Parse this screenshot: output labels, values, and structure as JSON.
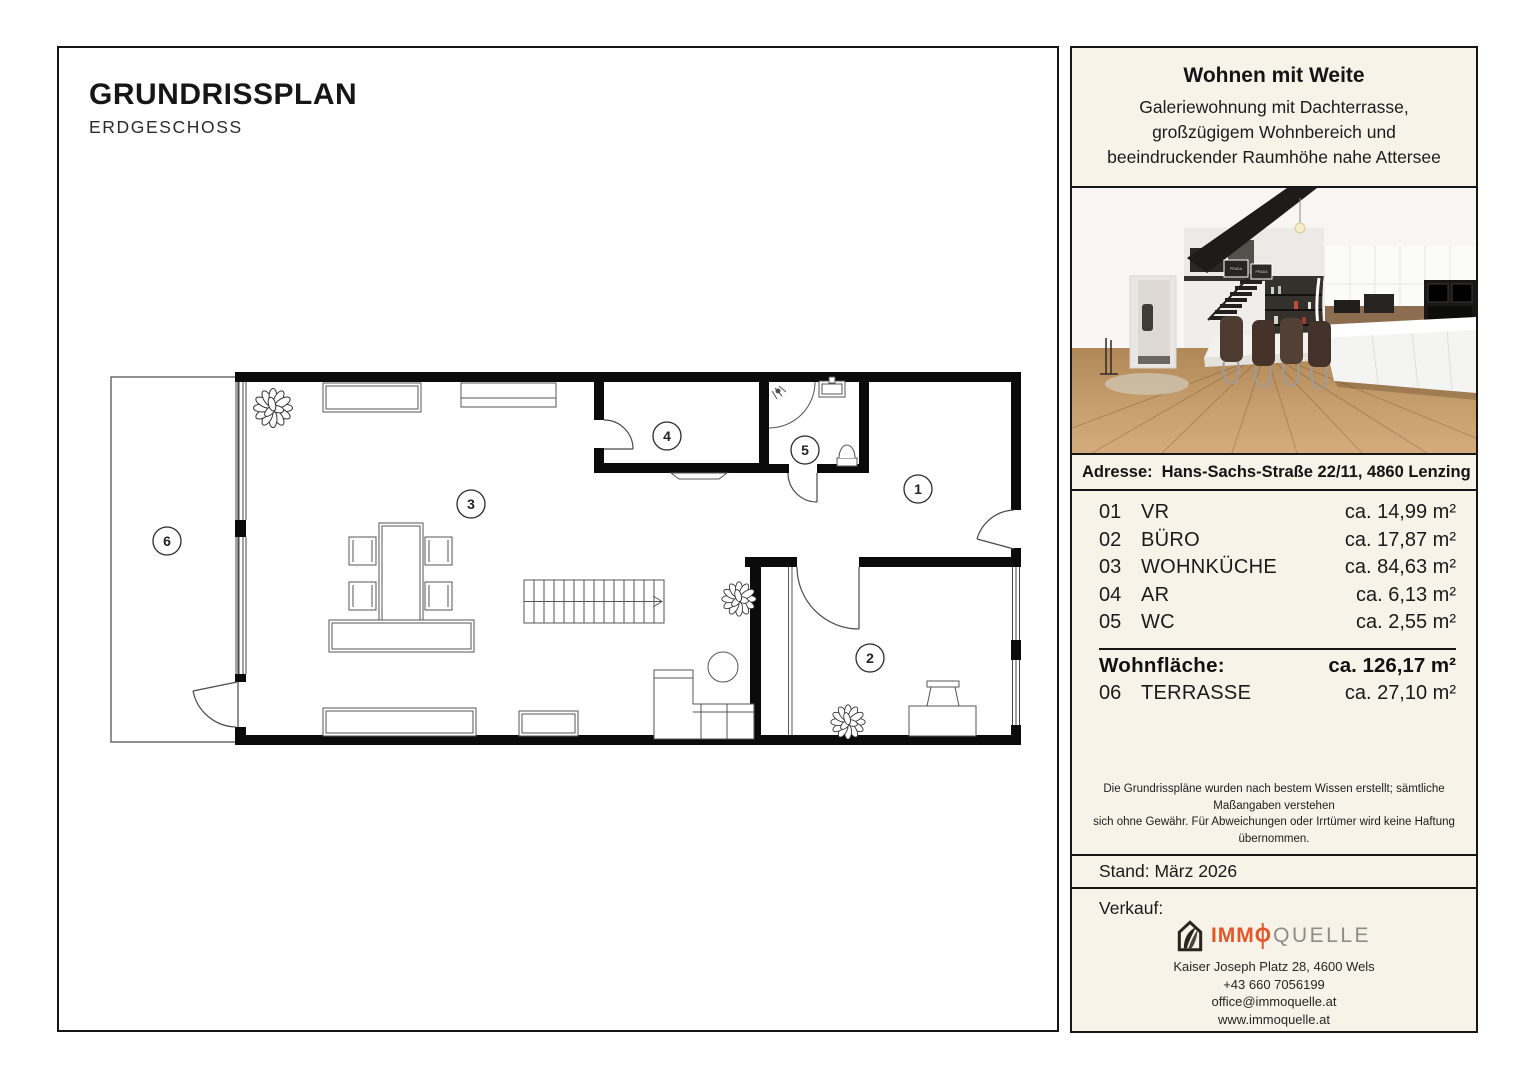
{
  "plan_box": {
    "title": "GRUNDRISSPLAN",
    "subtitle": "ERDGESCHOSS",
    "labels": [
      "1",
      "2",
      "3",
      "4",
      "5",
      "6"
    ]
  },
  "info_panel": {
    "header": {
      "title": "Wohnen mit Weite",
      "subtitle_lines": [
        "Galeriewohnung mit Dachterrasse,",
        "großzügigem Wohnbereich und",
        "beeindruckender Raumhöhe nahe Attersee"
      ]
    },
    "photo": {
      "sign_label": "PRADA"
    },
    "address": {
      "label": "Adresse:",
      "value": "Hans-Sachs-Straße 22/11, 4860 Lenzing"
    },
    "rooms": [
      {
        "no": "01",
        "name": "VR",
        "area": "ca. 14,99 m²"
      },
      {
        "no": "02",
        "name": "BÜRO",
        "area": "ca. 17,87 m²"
      },
      {
        "no": "03",
        "name": "WOHNKÜCHE",
        "area": "ca. 84,63 m²"
      },
      {
        "no": "04",
        "name": "AR",
        "area": "ca. 6,13 m²"
      },
      {
        "no": "05",
        "name": "WC",
        "area": "ca. 2,55 m²"
      }
    ],
    "total": {
      "label": "Wohnfläche:",
      "value": "ca. 126,17 m²"
    },
    "outdoor": {
      "no": "06",
      "name": "TERRASSE",
      "area": "ca. 27,10 m²"
    },
    "disclaimer_lines": [
      "Die Grundrisspläne wurden nach bestem Wissen erstellt; sämtliche Maßangaben verstehen",
      "sich ohne Gewähr. Für Abweichungen oder Irrtümer wird keine Haftung übernommen."
    ],
    "stand": "Stand: März 2026",
    "verkauf_label": "Verkauf:",
    "brand": {
      "immo_prefix": "IMM",
      "immo_o": "O",
      "quelle": "QUELLE",
      "orange": "#e2582a",
      "gray": "#8f8d88"
    },
    "contact_lines": [
      "Kaiser Joseph Platz 28, 4600 Wels",
      "+43 660 7056199",
      "office@immoquelle.at",
      "www.immoquelle.at"
    ]
  }
}
